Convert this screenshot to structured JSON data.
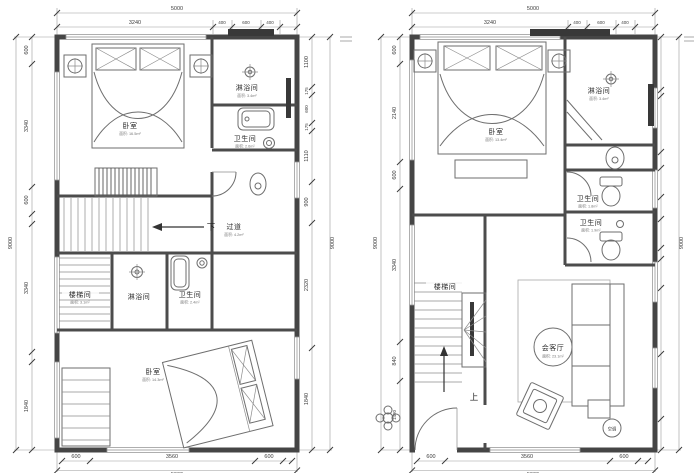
{
  "p1": {
    "dims": {
      "top_total": "5000",
      "top": [
        "3240",
        "400",
        "600",
        "400"
      ],
      "left_total": "9000",
      "left": [
        "600",
        "3340",
        "600",
        "3340",
        "1840"
      ],
      "right": [
        "1100",
        "175",
        "600",
        "175",
        "1110",
        "900",
        "2320",
        "1840"
      ],
      "right_total": "9000",
      "bottom": [
        "600",
        "3560",
        "600"
      ],
      "bottom_total": "5000"
    },
    "labels": {
      "bedroom_top": "卧室",
      "bedroom_top_area": "面积: 16.5m²",
      "shower_top": "淋浴间",
      "shower_top_area": "面积: 3.4m²",
      "toilet_top": "卫生间",
      "toilet_top_area": "面积: 2.6m²",
      "down": "下",
      "corridor": "过道",
      "corridor_area": "面积: 4.2m²",
      "stair": "楼梯间",
      "stair_area": "面积: 3.1m²",
      "shower_mid": "淋浴间",
      "toilet_mid": "卫生间",
      "toilet_mid_area": "面积: 2.4m²",
      "bedroom_bottom": "卧室",
      "bedroom_bottom_area": "面积: 14.3m²"
    }
  },
  "p2": {
    "dims": {
      "top_total": "5000",
      "top": [
        "3240",
        "400",
        "600",
        "400"
      ],
      "left_total": "9000",
      "left": [
        "600",
        "2140",
        "600",
        "3340",
        "840",
        "1480"
      ],
      "right": [
        "1100",
        "120",
        "1150",
        "335",
        "600",
        "455",
        "600",
        "235",
        "600",
        "1370",
        "1340",
        "600"
      ],
      "right_total": "9000",
      "bottom": [
        "600",
        "3560",
        "600"
      ],
      "bottom_total": "5000"
    },
    "labels": {
      "bedroom": "卧室",
      "bedroom_area": "面积: 13.4m²",
      "shower": "淋浴间",
      "shower_area": "面积: 3.4m²",
      "toilet_upper": "卫生间",
      "toilet_upper_area": "面积: 1.8m²",
      "toilet_lower": "卫生间",
      "toilet_lower_area": "面积: 1.9m²",
      "stair": "楼梯间",
      "up": "上",
      "living": "会客厅",
      "living_area": "面积: 23.1m²",
      "ac": "空调"
    }
  }
}
